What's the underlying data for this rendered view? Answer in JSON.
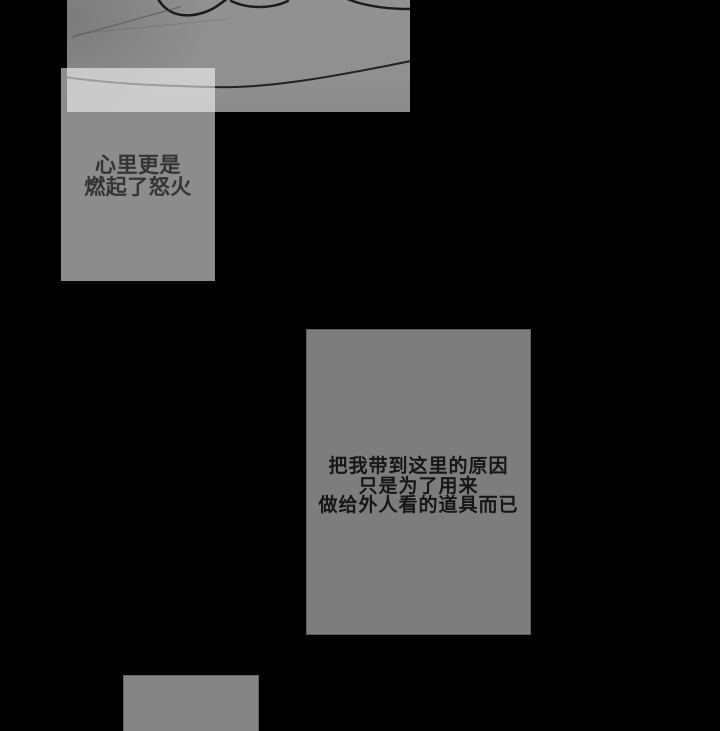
{
  "page": {
    "kind": "webtoon-comic-page",
    "background_color": "#000000"
  },
  "panel": {
    "description": "partial grayscale line-art panel (hand/figure close-up) cut by frame",
    "fill_color": "#909090",
    "line_color": "#1b1b1b",
    "faint_line_color": "#4a4a4a"
  },
  "bubbles": {
    "anger": {
      "text": "心里更是\n燃起了怒火",
      "lines": [
        "心里更是",
        "燃起了怒火"
      ],
      "overlay_color": "rgba(255,255,255,0.55)",
      "text_color": "#343434"
    },
    "reason": {
      "text": "把我带到这里的原因\n只是为了用来\n做给外人看的道具而已",
      "lines": [
        "把我带到这里的原因",
        "只是为了用来",
        "做给外人看的道具而已"
      ],
      "background_color": "#7d7d7d",
      "text_color": "#161616"
    },
    "partial": {
      "text": "",
      "background_color": "#848484",
      "note": "empty narration box cut off by bottom edge"
    }
  }
}
